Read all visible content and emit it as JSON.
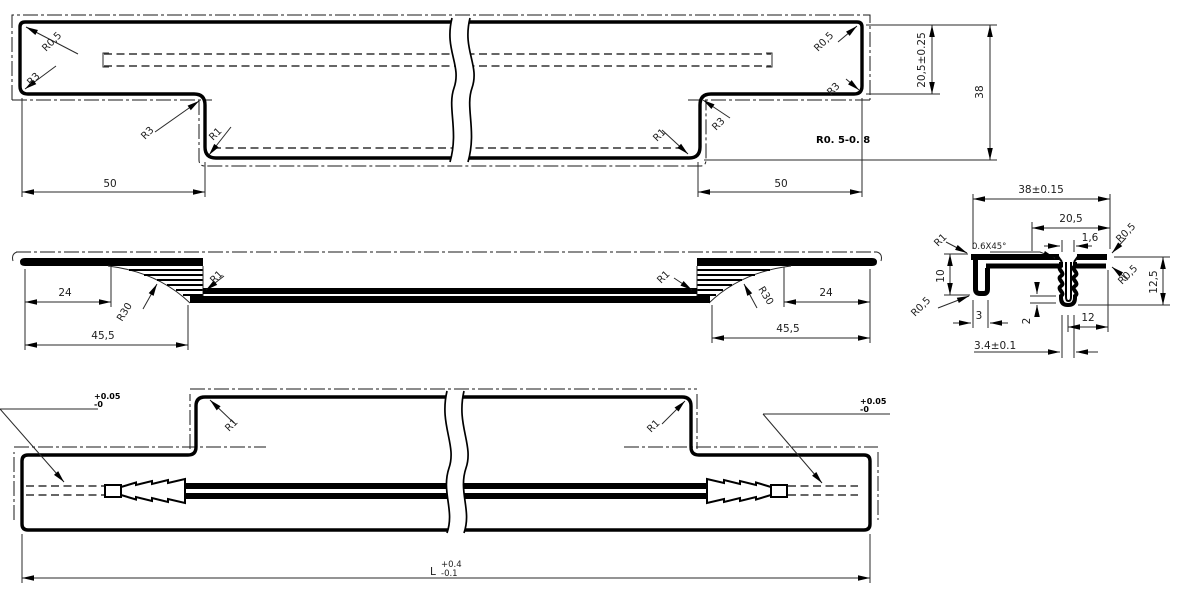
{
  "views": {
    "top": {
      "r05_left": "R0,5",
      "r3_left": "R3",
      "r3_step_left": "R3",
      "r1_step_left": "R1",
      "r1_step_right": "R1",
      "r3_step_right": "R3",
      "r3_right": "R3",
      "r05_right": "R0,5",
      "surface_note": "R0. 5-0. 8",
      "dim_50_left": "50",
      "dim_50_right": "50",
      "dim_end_height": "20,5±0.25",
      "dim_total_height": "38"
    },
    "front": {
      "r1_left": "R1",
      "r1_right": "R1",
      "r30_left": "R30",
      "r30_right": "R30",
      "dim_24_left": "24",
      "dim_455_left": "45,5",
      "dim_24_right": "24",
      "dim_455_right": "45,5"
    },
    "section": {
      "dim_overall": "38±0.15",
      "dim_flange": "20,5",
      "dim_slot": "1,6",
      "dim_depth": "12,5",
      "dim_leg": "10",
      "dim_hem": "3",
      "dim_offset": "12",
      "dim_channel": "3.4±0.1",
      "dim_rib": "2",
      "chamfer_note": "0.6X45°",
      "r1": "R1",
      "r05_top_right": "R0,5",
      "r05_mid_right": "R0,5",
      "r05_bottom_left": "R0,5"
    },
    "bottom": {
      "r1_left": "R1",
      "r1_right": "R1",
      "tol_plus_left": "+0.05",
      "tol_minus_left": "-0",
      "tol_plus_right": "+0.05",
      "tol_minus_right": "-0",
      "length_label": "L",
      "length_plus": "+0.4",
      "length_minus": "-0.1"
    }
  }
}
